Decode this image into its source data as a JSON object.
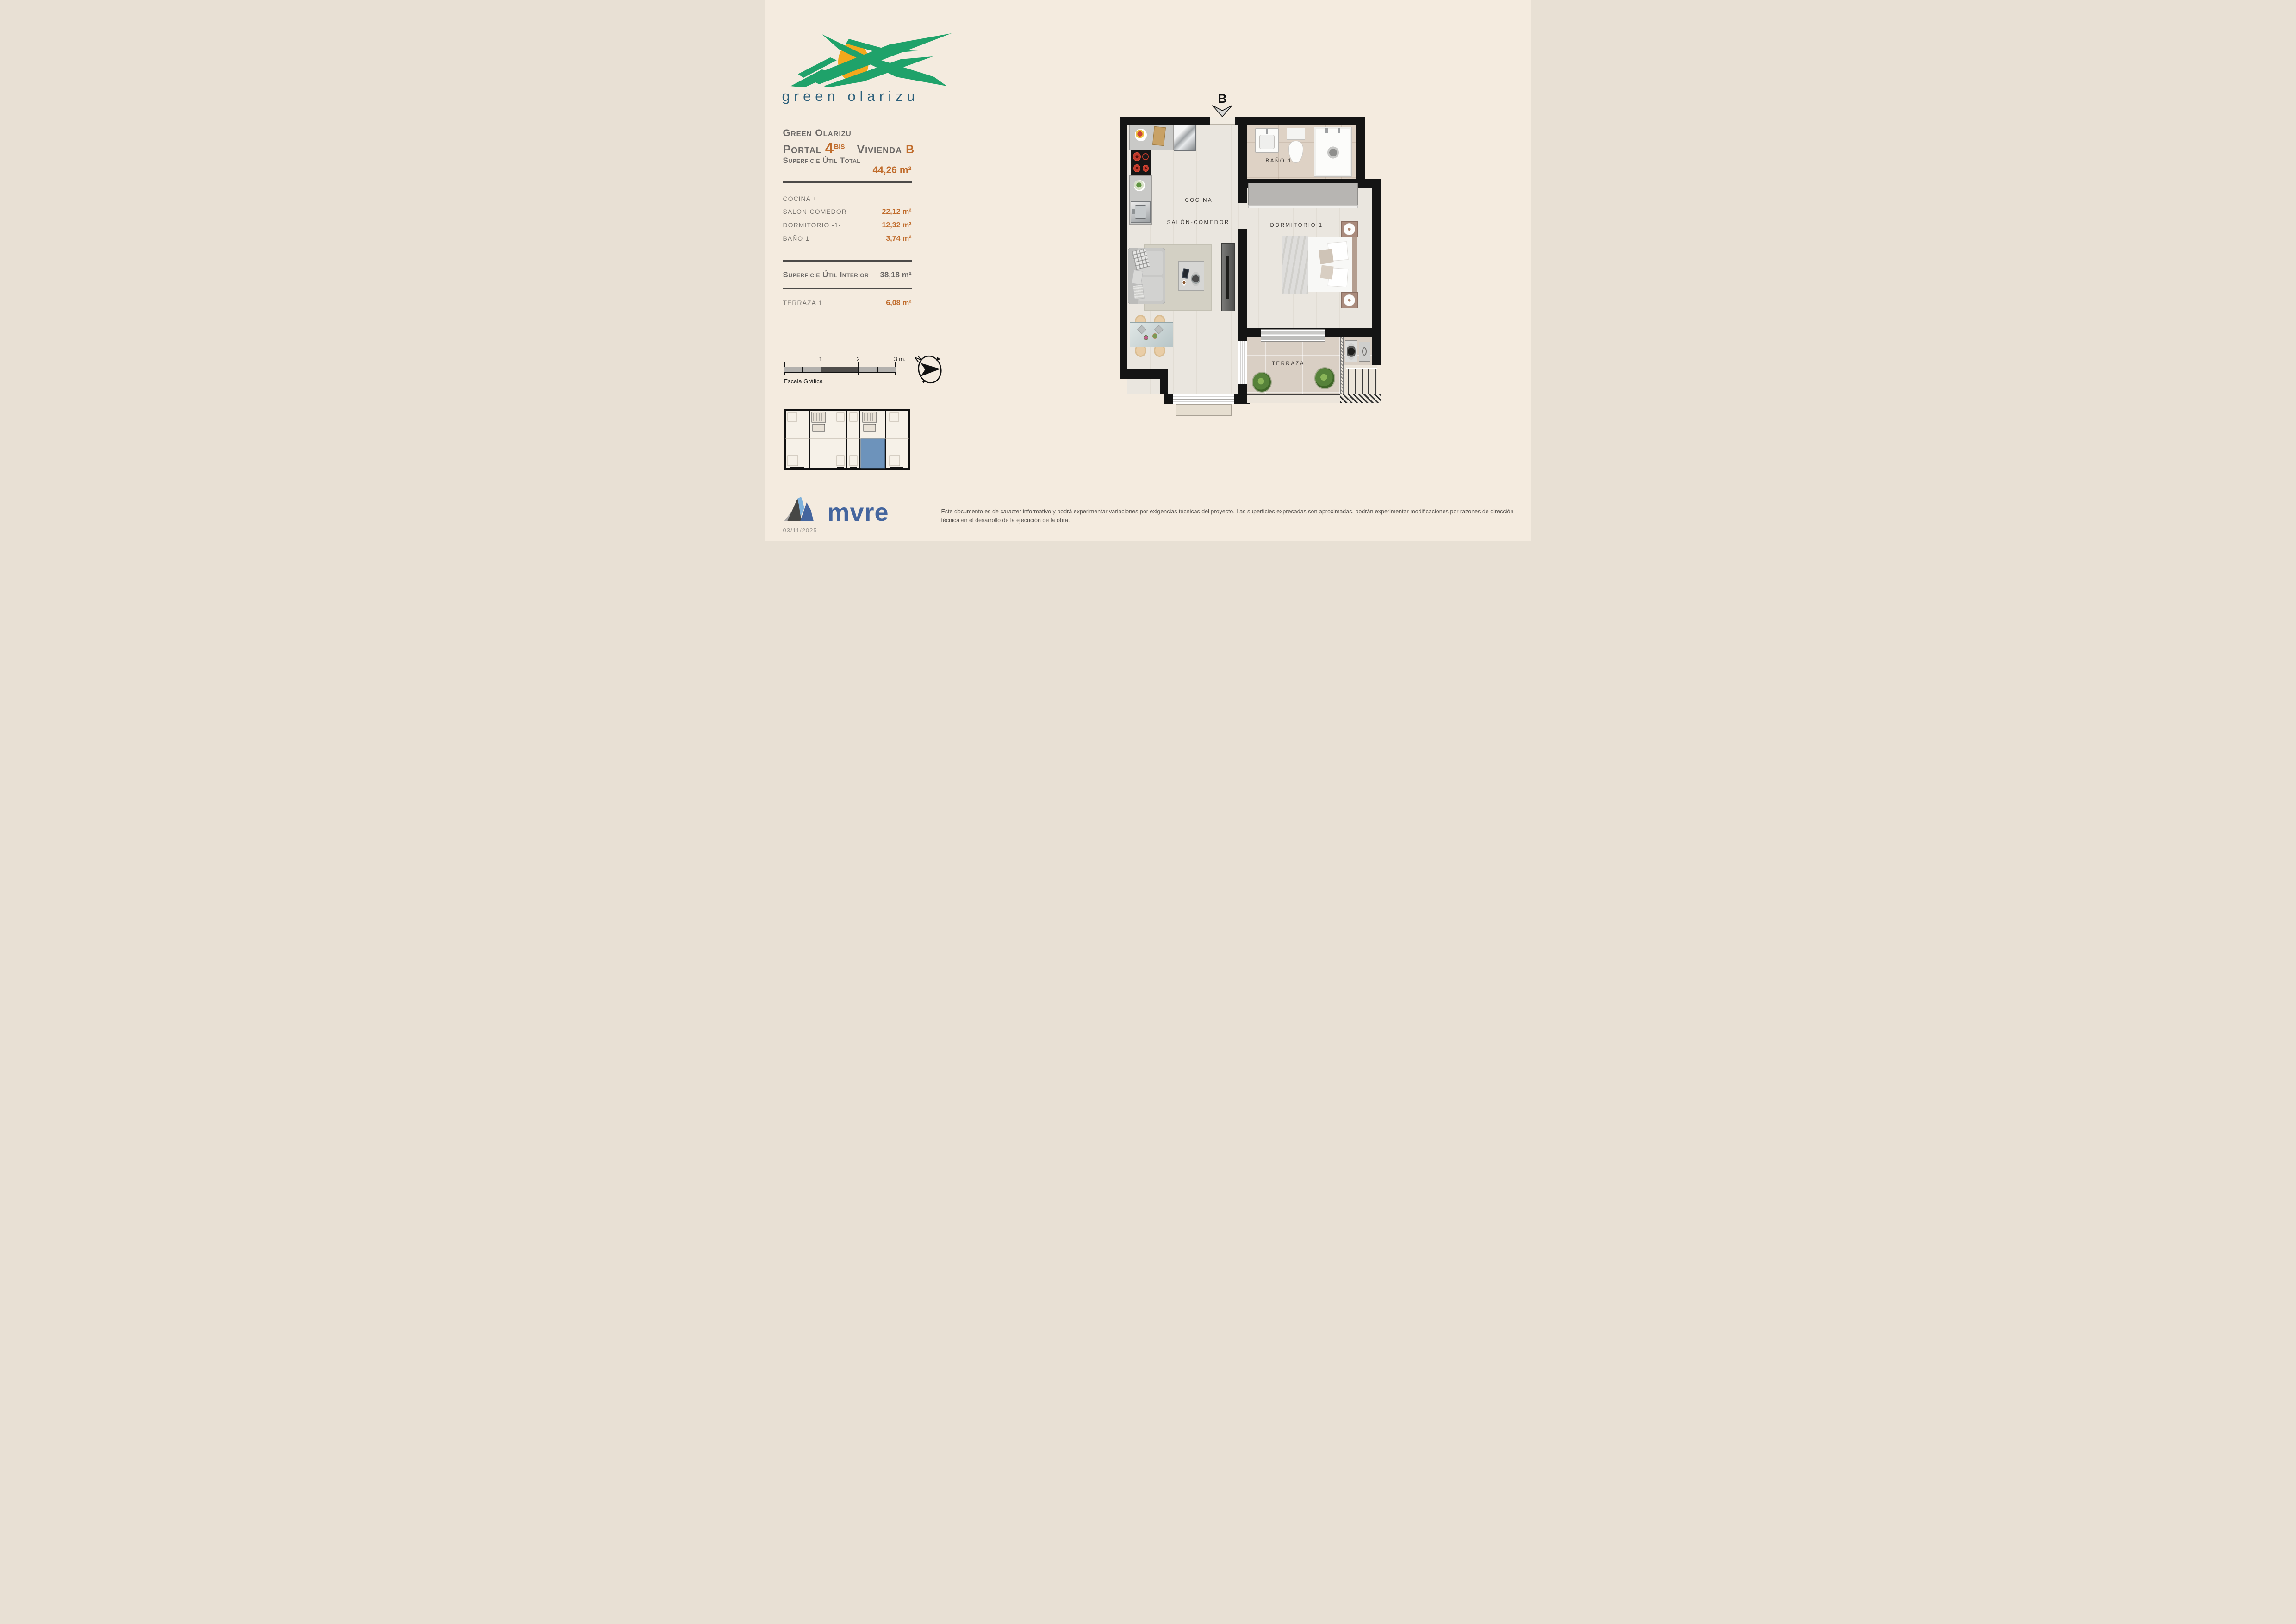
{
  "brand": {
    "logo_text": "green olarizu"
  },
  "header": {
    "project": "Green Olarizu",
    "portal_label": "Portal",
    "portal_number": "4",
    "portal_sup": "BIS",
    "vivienda_label": "Vivienda",
    "vivienda_value": "B"
  },
  "areas": {
    "total_label": "Superficie Útil Total",
    "total_value": "44,26 m²",
    "rows": [
      {
        "label": "COCINA +",
        "value": ""
      },
      {
        "label": "SALON-COMEDOR",
        "value": "22,12 m²"
      },
      {
        "label": "DORMITORIO -1-",
        "value": "12,32 m²"
      },
      {
        "label": "BAÑO 1",
        "value": "3,74 m²"
      }
    ],
    "interior_label": "Superficie Útil Interior",
    "interior_value": "38,18 m²",
    "terraza_label": "TERRAZA 1",
    "terraza_value": "6,08 m²"
  },
  "plan": {
    "section_marker": "B",
    "labels": {
      "cocina": "COCINA",
      "salon": "SALÓN-COMEDOR",
      "bano": "BAÑO 1",
      "dormitorio": "DORMITORIO 1",
      "terraza": "TERRAZA"
    }
  },
  "scale_bar": {
    "tick_1": "1",
    "tick_2": "2",
    "tick_3": "3 m.",
    "caption": "Escala Gráfica"
  },
  "compass": {
    "north": "N"
  },
  "footer": {
    "logo_text": "mvre",
    "date": "03/11/2025",
    "disclaimer": "Este documento es de caracter informativo y podrá experimentar variaciones por exigencias técnicas del proyecto. Las superficies expresadas son aproximadas, podrán experimentar modificaciones por razones de dirección técnica en el desarrollo de la ejecución de la obra."
  },
  "colors": {
    "background": "#f4ebdf",
    "accent_orange": "#c06c2c",
    "heading_gray": "#6b6866",
    "brand_green": "#1fa26a",
    "brand_sun": "#f3a81c",
    "brand_blue": "#2b5f7b",
    "mvre_blue": "#44659e",
    "wall_black": "#141414",
    "highlight_unit": "#6d93bb"
  }
}
